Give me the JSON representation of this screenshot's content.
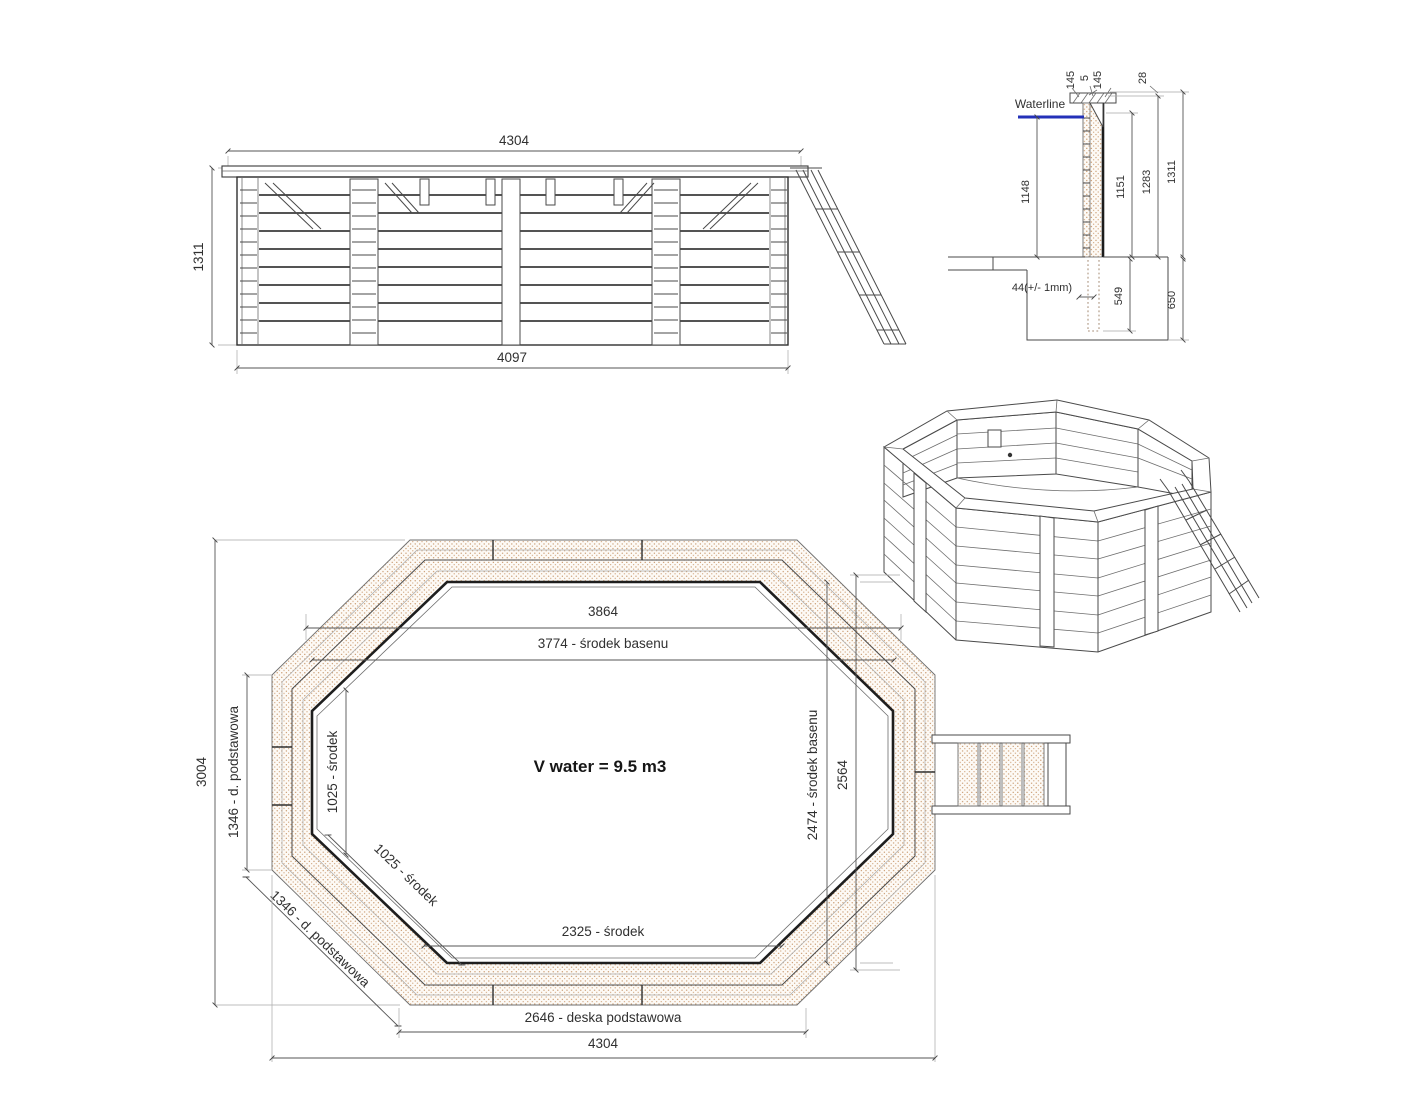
{
  "elevation": {
    "width_top": "4304",
    "height_left": "1311",
    "width_bottom": "4097"
  },
  "section": {
    "waterline": "Waterline",
    "cap_board_a": "145",
    "cap_gap": "5",
    "cap_board_b": "145",
    "rim_offset": "28",
    "water_depth": "1148",
    "inner_height": "1151",
    "outer_height": "1283",
    "total_height": "1311",
    "anchor_offset": "44(+/- 1mm)",
    "post_embed": "549",
    "foundation": "650"
  },
  "plan": {
    "top_inner": "3864",
    "top_center": "3774 - środek basenu",
    "overall_h": "3004",
    "left_base": "1346 - d. podstawowa",
    "left_center": "1025 - środek",
    "diag_center": "1025 - środek",
    "diag_base": "1346 - d. podstawowa",
    "bottom_center": "2325 - środek",
    "bottom_base": "2646 - deska podstawowa",
    "overall_w": "4304",
    "right_h": "2564",
    "right_center": "2474 - środek basenu",
    "volume": "V water = 9.5 m3"
  }
}
